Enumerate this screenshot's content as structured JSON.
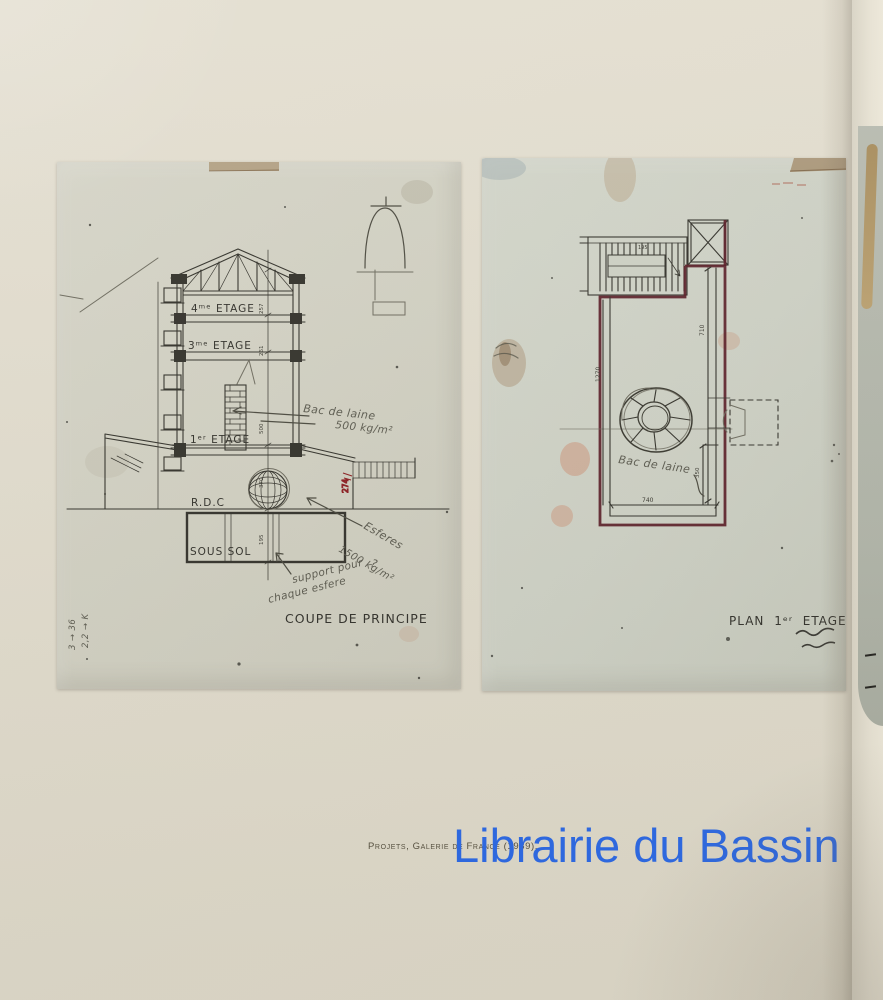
{
  "watermark": {
    "text": "Librairie du Bassin",
    "color": "#2b68e5"
  },
  "caption": {
    "text": "Projets, Galerie de France (1989)."
  },
  "coupe": {
    "title": "COUPE DE PRINCIPE",
    "floors": {
      "f4": "4ᵐᵉ ETAGE",
      "f3": "3ᵐᵉ ETAGE",
      "f1": "1ᵉʳ ETAGE",
      "rdc": "R.D.C",
      "ss": "SOUS SOL"
    },
    "dims": [
      "257",
      "261",
      "500",
      "370",
      "195"
    ],
    "notes": {
      "roof1": "Bac de laine",
      "roof2": "500 kg/m²",
      "sph1": "Esferes",
      "sph2": "1500 kg/m²",
      "sph3": "?",
      "sup1": "support pour",
      "sup2": "chaque esfere",
      "corner1": "3 → 36",
      "corner2": "2,2 → K",
      "red": "274"
    }
  },
  "plan": {
    "title": "PLAN  1ᵉʳ ETAGE",
    "dims": {
      "height": "710",
      "left": "1270",
      "width": "740",
      "alcove": "350",
      "stair": "195"
    },
    "notes": {
      "sphere": "Bac de laine"
    }
  }
}
